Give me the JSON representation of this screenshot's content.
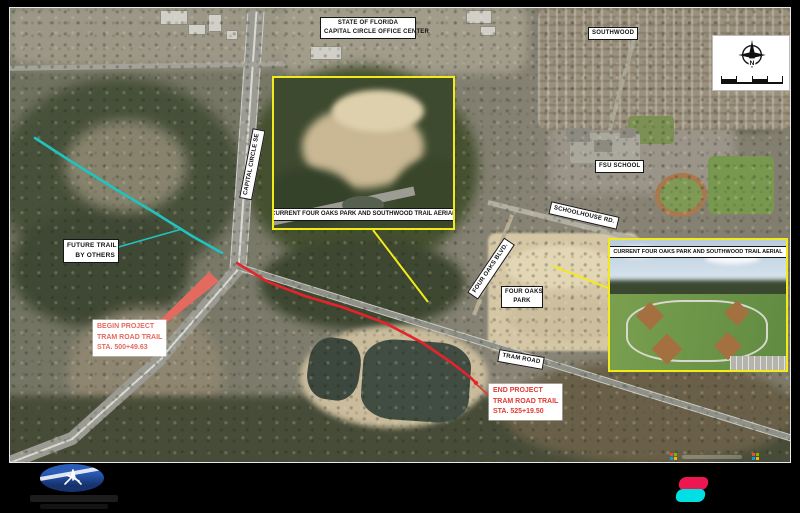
{
  "title_block": {
    "state_label_line1": "STATE OF FLORIDA",
    "state_label_line2": "CAPITAL CIRCLE OFFICE CENTER"
  },
  "map_labels": {
    "southwood": "SOUTHWOOD",
    "fsu_school": "FSU SCHOOL",
    "schoolhouse_rd": "SCHOOLHOUSE RD.",
    "capital_circle_se": "CAPITAL CIRCLE SE",
    "four_oaks_blvd": "FOUR OAKS BLVD.",
    "four_oaks_park_line1": "FOUR OAKS",
    "four_oaks_park_line2": "PARK",
    "tram_road": "TRAM ROAD"
  },
  "callouts": {
    "future_trail_line1": "FUTURE TRAIL",
    "future_trail_line2": "BY OTHERS",
    "begin_line1": "BEGIN PROJECT",
    "begin_line2": "TRAM ROAD TRAIL",
    "begin_line3": "STA. 500+49.63",
    "end_line1": "END PROJECT",
    "end_line2": "TRAM ROAD TRAIL",
    "end_line3": "STA. 525+19.50"
  },
  "insets": {
    "center_caption_line1": "CURRENT FOUR OAKS PARK AND",
    "center_caption_line2": "SOUTHWOOD TRAIL AERIAL",
    "right_caption_line1": "CURRENT FOUR OAKS PARK AND",
    "right_caption_line2": "SOUTHWOOD TRAIL AERIAL"
  },
  "compass": {
    "north_letter": "N"
  },
  "colors": {
    "trail_future": "#1FC4C0",
    "trail_project": "#E6232B",
    "begin_callout": "#E4695E",
    "end_callout": "#DF3A32",
    "highlight_yellow": "#F2EB1A",
    "logo_blue": "#2A5CB8",
    "brand_pink": "#ED1650",
    "brand_cyan": "#00DFE4",
    "ms_red": "#F25022",
    "ms_green": "#7FBA00",
    "ms_blue": "#00A4EF",
    "ms_yellow": "#FFB900"
  }
}
